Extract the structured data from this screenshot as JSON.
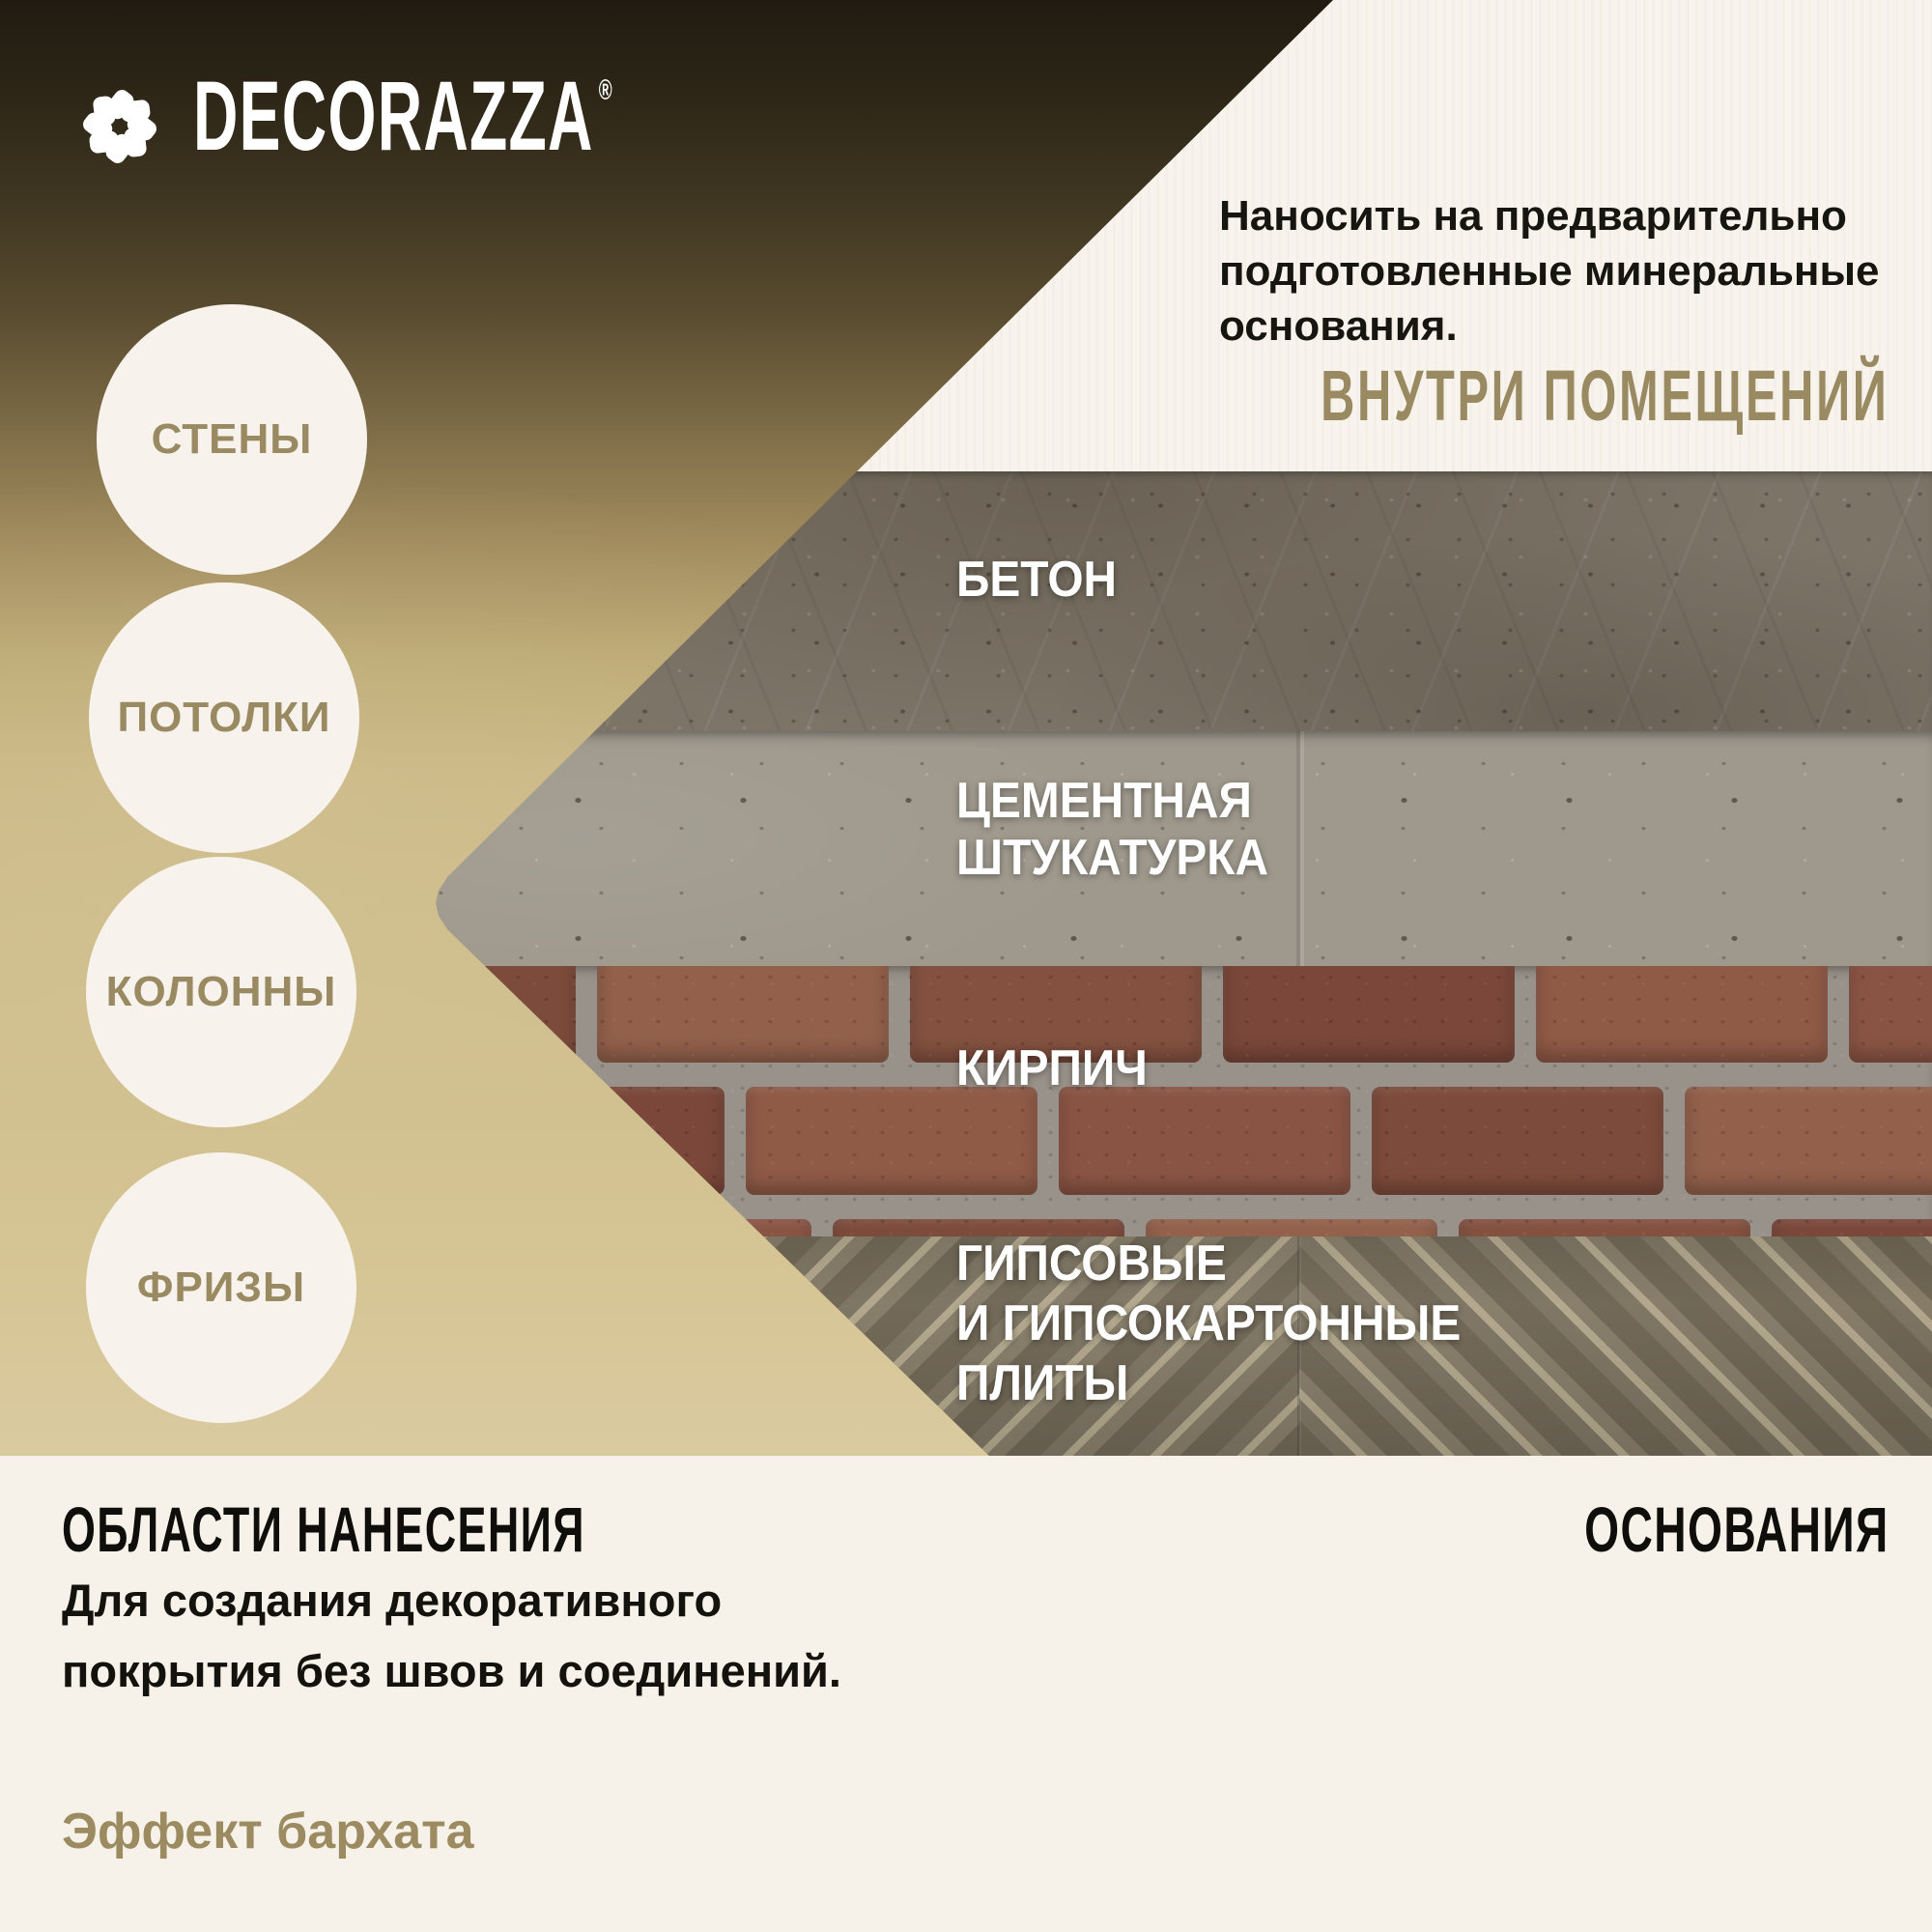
{
  "brand": {
    "name": "DECORAZZA",
    "mark": "®",
    "logo_icon": "pinwheel-flower-icon"
  },
  "header": {
    "note_lines": [
      "Наносить на предварительно",
      "подготовленные минеральные",
      "основания."
    ],
    "location_label": "ВНУТРИ ПОМЕЩЕНИЙ"
  },
  "application_areas": {
    "items": [
      {
        "label": "СТЕНЫ"
      },
      {
        "label": "ПОТОЛКИ"
      },
      {
        "label": "КОЛОННЫ"
      },
      {
        "label": "ФРИЗЫ"
      }
    ]
  },
  "substrates": {
    "bands": [
      {
        "id": "concrete",
        "label_lines": [
          "БЕТОН"
        ]
      },
      {
        "id": "cement-plaster",
        "label_lines": [
          "ЦЕМЕНТНАЯ",
          "ШТУКАТУРКА"
        ]
      },
      {
        "id": "brick",
        "label_lines": [
          "КИРПИЧ"
        ]
      },
      {
        "id": "gypsum-boards",
        "label_lines": [
          "ГИПСОВЫЕ",
          "И ГИПСОКАРТОННЫЕ",
          "ПЛИТЫ"
        ]
      }
    ]
  },
  "footer": {
    "left_title": "ОБЛАСТИ НАНЕСЕНИЯ",
    "right_title": "ОСНОВАНИЯ",
    "description_lines": [
      "Для создания декоративного",
      "покрытия без швов и соединений."
    ],
    "effect_label": "Эффект бархата"
  },
  "colors": {
    "accent_tan": "#9a8a62",
    "cream": "#f7f3ec",
    "footer_background": "#f6f2e9",
    "dark_text": "#16140e",
    "label_white": "#ffffff",
    "gradient_top": "#211b11",
    "gradient_bottom": "#dacaa0"
  }
}
